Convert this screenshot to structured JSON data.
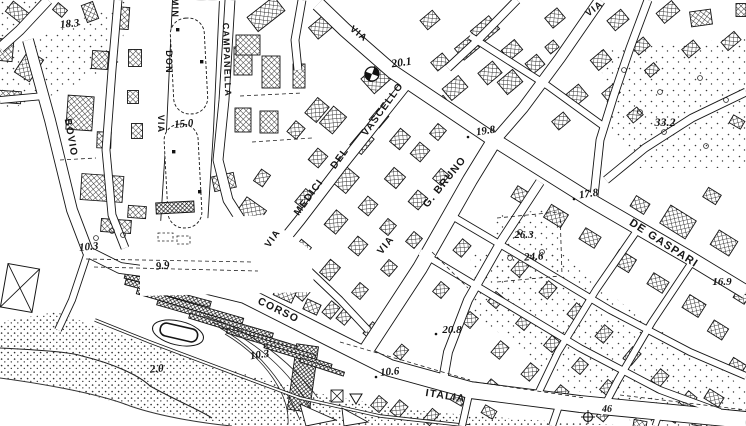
{
  "map": {
    "type": "black-and-white city topographic map (Italian cadastral style)",
    "colors": {
      "ink": "#151515",
      "paper": "#ffffff"
    },
    "street_labels": [
      {
        "id": "via-artery-top",
        "text": "VIA",
        "x": 357,
        "y": 36,
        "rotate": 38,
        "size": 9.5
      },
      {
        "id": "via-vascello-word-via",
        "text": "VIA",
        "x": 275,
        "y": 240,
        "rotate": -55,
        "size": 9.5
      },
      {
        "id": "via-vascello-word-medici",
        "text": "MEDICI",
        "x": 311,
        "y": 199,
        "rotate": -54,
        "size": 10
      },
      {
        "id": "via-vascello-word-del",
        "text": "DEL",
        "x": 342,
        "y": 160,
        "rotate": -54,
        "size": 10
      },
      {
        "id": "via-vascello-word-vascello",
        "text": "VASCELLO",
        "x": 385,
        "y": 111,
        "rotate": -54,
        "size": 10
      },
      {
        "id": "via-g-bruno-word-via",
        "text": "VIA",
        "x": 388,
        "y": 247,
        "rotate": -51,
        "size": 10
      },
      {
        "id": "via-g-bruno-word-bruno",
        "text": "G. BRUNO",
        "x": 447,
        "y": 184,
        "rotate": -51,
        "size": 10.5
      },
      {
        "id": "corso-italia-word-corso",
        "text": "CORSO",
        "x": 277,
        "y": 313,
        "rotate": 26,
        "size": 10.5
      },
      {
        "id": "corso-italia-word-italia",
        "text": "ITALIA",
        "x": 445,
        "y": 399,
        "rotate": 9,
        "size": 10.5
      },
      {
        "id": "via-de-gaspari",
        "text": "DE GASPARI",
        "x": 662,
        "y": 246,
        "rotate": 33,
        "size": 11
      },
      {
        "id": "via-top-right",
        "text": "VIA",
        "x": 596,
        "y": 11,
        "rotate": -37,
        "size": 9.5
      },
      {
        "id": "via-bovio",
        "text": "BOVIO",
        "x": 68,
        "y": 138,
        "rotate": 80,
        "size": 10
      },
      {
        "id": "via-don-minzoni-word-via",
        "text": "VIA",
        "x": 158,
        "y": 124,
        "rotate": 90,
        "size": 9
      },
      {
        "id": "via-don-minzoni-word-don",
        "text": "DON",
        "x": 166,
        "y": 62,
        "rotate": 90,
        "size": 9
      },
      {
        "id": "via-don-minzoni-word-min",
        "text": "MIN",
        "x": 172,
        "y": 8,
        "rotate": 90,
        "size": 9
      },
      {
        "id": "via-campanella",
        "text": "CAMPANELLA",
        "x": 224,
        "y": 60,
        "rotate": 88,
        "size": 9
      }
    ],
    "spot_heights": [
      {
        "value": "18.3",
        "x": 70,
        "y": 27,
        "rotate": -6,
        "size": 11
      },
      {
        "value": "15.0",
        "x": 184,
        "y": 127,
        "rotate": -5,
        "size": 11
      },
      {
        "value": "10.3",
        "x": 89,
        "y": 250,
        "rotate": -5,
        "size": 11
      },
      {
        "value": "9.9",
        "x": 163,
        "y": 269,
        "rotate": -6,
        "size": 11
      },
      {
        "value": "20.1",
        "x": 402,
        "y": 66,
        "rotate": -8,
        "size": 11.5
      },
      {
        "value": "19.8",
        "x": 486,
        "y": 134,
        "rotate": -8,
        "size": 11
      },
      {
        "value": "33.2",
        "x": 665,
        "y": 126,
        "rotate": 0,
        "size": 12
      },
      {
        "value": "17.8",
        "x": 589,
        "y": 197,
        "rotate": -8,
        "size": 11
      },
      {
        "value": "26.3",
        "x": 524,
        "y": 238,
        "rotate": 0,
        "size": 11
      },
      {
        "value": "24.6",
        "x": 534,
        "y": 260,
        "rotate": -4,
        "size": 11
      },
      {
        "value": "16.9",
        "x": 722,
        "y": 285,
        "rotate": 0,
        "size": 11
      },
      {
        "value": "20.8",
        "x": 452,
        "y": 333,
        "rotate": 0,
        "size": 11
      },
      {
        "value": "10.6",
        "x": 390,
        "y": 375,
        "rotate": -5,
        "size": 11
      },
      {
        "value": "10.3",
        "x": 260,
        "y": 358,
        "rotate": -8,
        "size": 11
      },
      {
        "value": "2.0",
        "x": 157,
        "y": 372,
        "rotate": -5,
        "size": 11
      },
      {
        "value": "46",
        "x": 607,
        "y": 412,
        "rotate": 0,
        "size": 10
      }
    ],
    "symbols": [
      {
        "name": "church-cross-symbol",
        "x": 372,
        "y": 74
      },
      {
        "name": "benchmark-cross-symbol",
        "x": 588,
        "y": 417
      },
      {
        "name": "chapel-triangle-symbol",
        "x": 356,
        "y": 399
      },
      {
        "name": "crossed-shed-symbol",
        "x": 20,
        "y": 288
      }
    ]
  }
}
